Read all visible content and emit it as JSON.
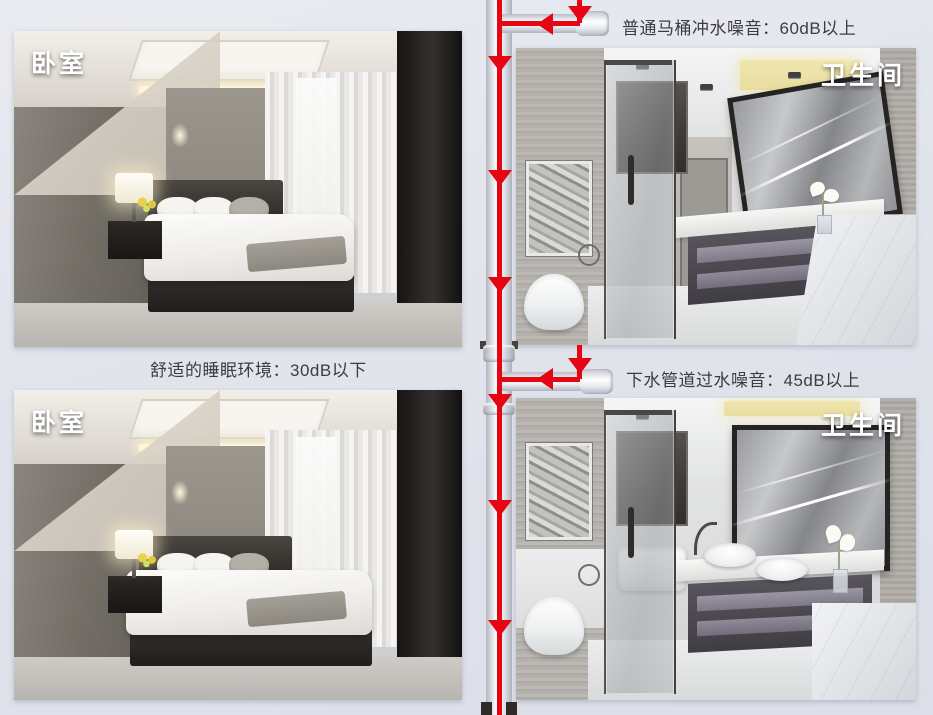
{
  "panels": {
    "bedroom_top": {
      "label": "卧室"
    },
    "bathroom_top": {
      "label": "卫生间"
    },
    "bedroom_bottom": {
      "label": "卧室"
    },
    "bathroom_bottom": {
      "label": "卫生间"
    }
  },
  "annotations": {
    "toilet_flush_noise": "普通马桶冲水噪音：60dB以上",
    "sleep_environment": "舒适的睡眠环境：30dB以下",
    "drain_flow_noise": "下水管道过水噪音：45dB以上"
  },
  "colors": {
    "flow_red": "#e60613",
    "background": "#e2e4ec",
    "pipe_white": "#fbfcfe",
    "annotation_text": "#3c3c41",
    "panel_label_text": "#ffffff"
  }
}
